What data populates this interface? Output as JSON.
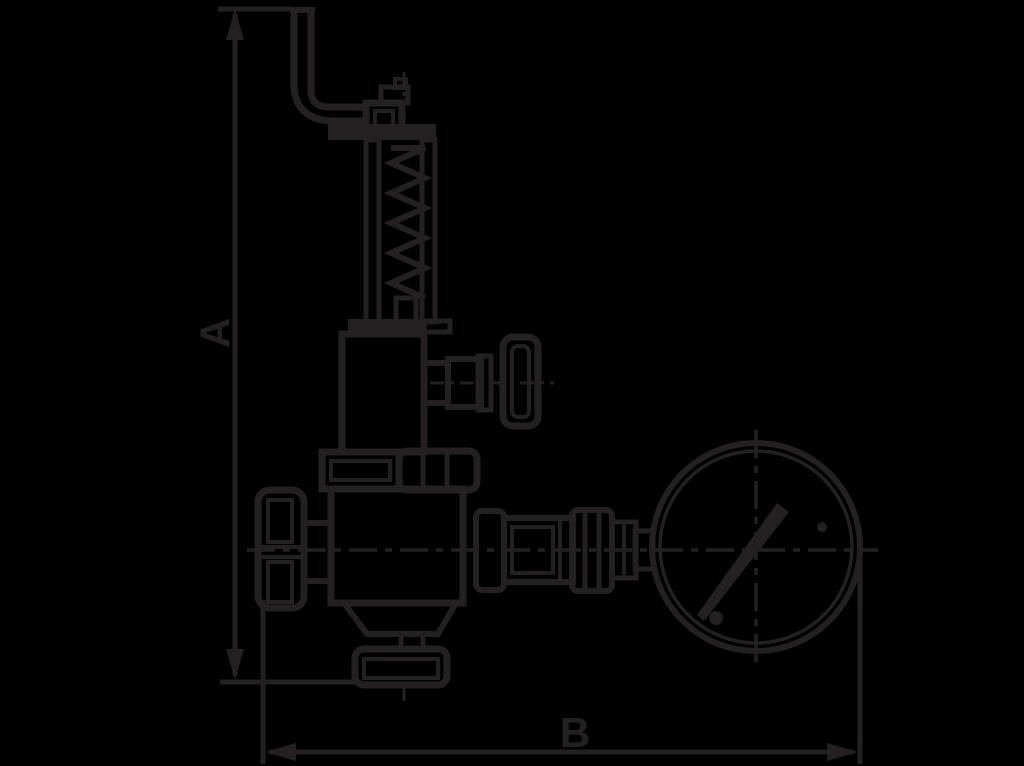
{
  "scene": {
    "background_color": "#000000",
    "line_color": "#242021",
    "dimension_labels": {
      "vertical": "A",
      "horizontal": "B"
    },
    "parts": [
      "test-lever",
      "spring-column",
      "bonnet",
      "side-plug",
      "union-nut",
      "valve-body",
      "handwheel",
      "outlet-cone",
      "bottom-flange",
      "gauge-fitting",
      "pressure-gauge"
    ]
  }
}
